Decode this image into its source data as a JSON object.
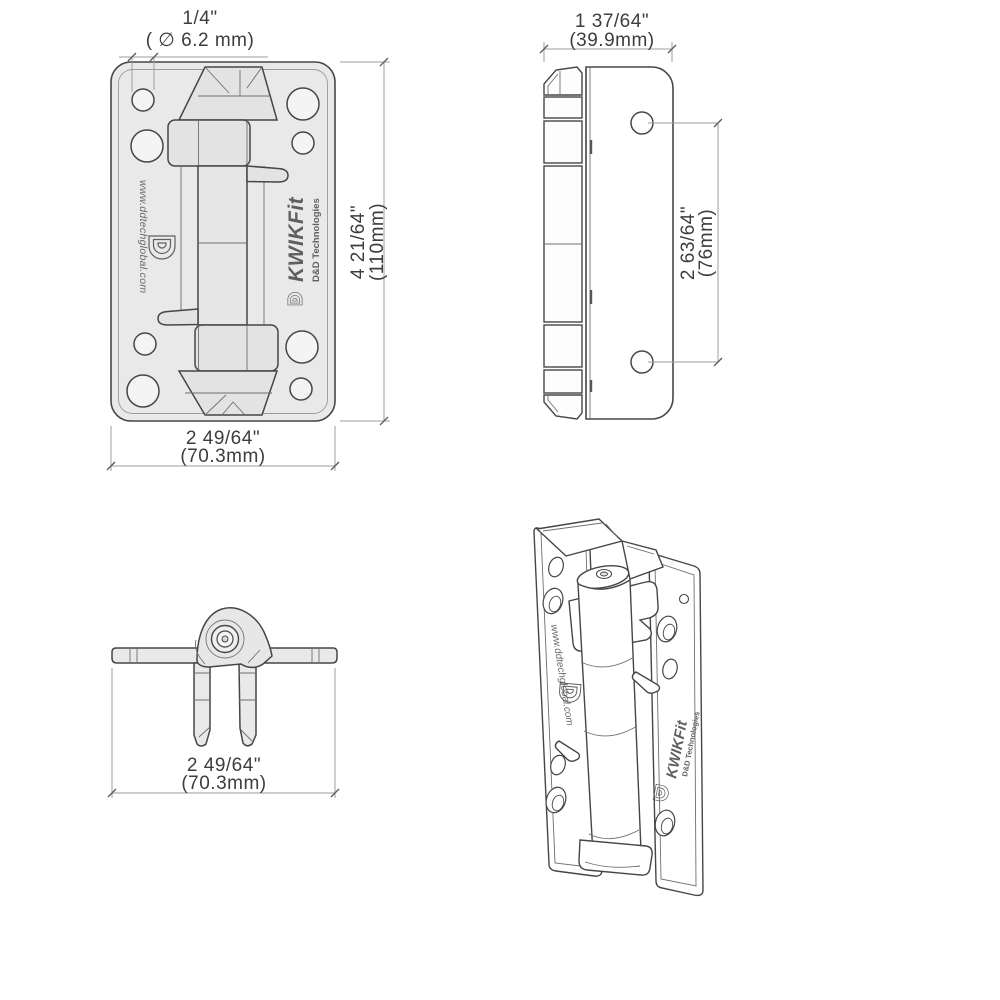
{
  "document": {
    "type": "technical-dimension-drawing",
    "background": "#ffffff",
    "subject": "gate hinge, four orthographic and isometric views"
  },
  "branding": {
    "logo_glyph": "D",
    "product": "KWIKFit",
    "company": "D&D Technologies",
    "website": "www.ddtechglobal.com"
  },
  "colors": {
    "line": "#464646",
    "plate_fill": "#e9e9e9",
    "mech_fill": "#e3e3e3",
    "dim_line": "#9e9e9e",
    "dim_text": "#3d3d3d",
    "brand_text": "#5f5f5f",
    "white": "#ffffff"
  },
  "views": {
    "front": {
      "label": "front view",
      "dim_hole": {
        "imperial": "1/4\"",
        "metric": "( ∅ 6.2 mm)"
      },
      "dim_height": {
        "imperial": "4  21/64\"",
        "metric": "(110mm)"
      },
      "dim_width": {
        "imperial": "2  49/64\"",
        "metric": "(70.3mm)"
      }
    },
    "side": {
      "label": "side view",
      "dim_width": {
        "imperial": "1  37/64\"",
        "metric": "(39.9mm)"
      },
      "dim_hole_spacing": {
        "imperial": "2  63/64\"",
        "metric": "(76mm)"
      }
    },
    "folded": {
      "label": "folded top view",
      "dim_width": {
        "imperial": "2  49/64\"",
        "metric": "(70.3mm)"
      }
    },
    "isometric": {
      "label": "isometric view"
    }
  }
}
